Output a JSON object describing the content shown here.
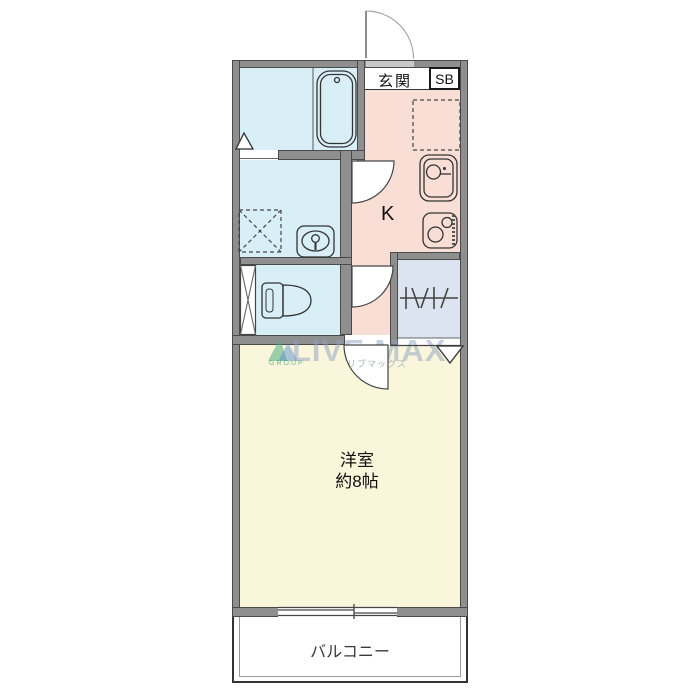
{
  "labels": {
    "entrance": "玄関",
    "shoe_box": "SB",
    "kitchen": "K",
    "room_name": "洋室",
    "room_size": "約8帖",
    "balcony": "バルコニー"
  },
  "watermark": {
    "brand": "LIVE MAX",
    "group": "GROUP",
    "katakana": "リブマックス"
  },
  "fixtures": [
    "bathtub",
    "wash-basin",
    "washing-machine-space",
    "toilet",
    "pipe-space",
    "kitchen-sink",
    "gas-stove",
    "refrigerator-space",
    "closet-hanger-pipe",
    "entrance-door",
    "washroom-door",
    "toilet-door",
    "room-door",
    "sliding-window"
  ],
  "colors": {
    "wall": "#8f8f8f",
    "wall_edge": "#4a4a4a",
    "wet_room": "#d9eff8",
    "kitchen": "#f9ded5",
    "closet": "#dbe4f0",
    "living_room": "#faf6dc",
    "watermark_text": "#8fa2c4",
    "watermark_green": "#4fae7e",
    "watermark_blue": "#5b8fd0"
  }
}
